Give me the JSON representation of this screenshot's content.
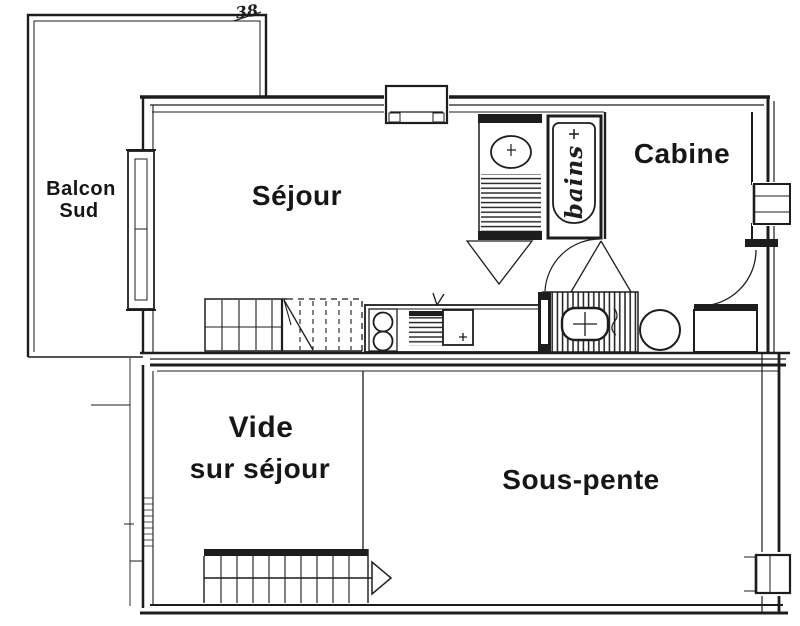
{
  "drawing": {
    "annotation": "38",
    "labels": {
      "balcony_line1": "Balcon",
      "balcony_line2": "Sud",
      "living": "Séjour",
      "cabin": "Cabine",
      "bath": "bains",
      "void_line1": "Vide",
      "void_line2": "sur séjour",
      "attic": "Sous-pente"
    },
    "colors": {
      "ink": "#1d1d1d",
      "paper": "#ffffff"
    }
  }
}
